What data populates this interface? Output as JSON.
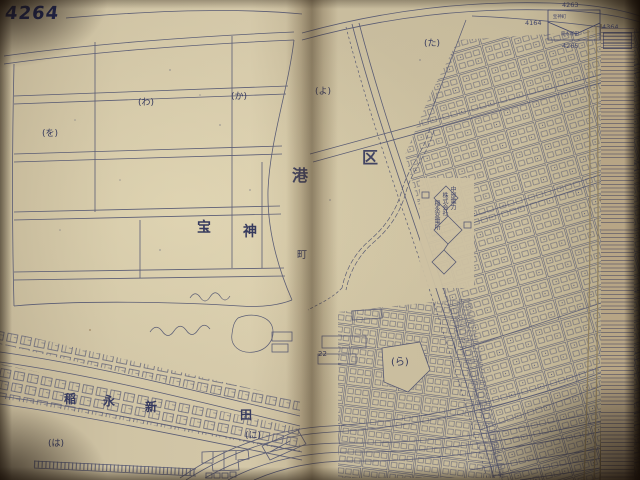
{
  "colors": {
    "ink": "#4a4e6e",
    "paper": "#cdc1a2",
    "handwriting": "#232c63"
  },
  "sheet": {
    "number": "4264"
  },
  "district": {
    "char_left": "港",
    "char_right": "区"
  },
  "left_page": {
    "town": {
      "char1": "宝",
      "char2": "神",
      "char3": "町"
    },
    "blocks": {
      "b1": "(を)",
      "b2": "(わ)",
      "b3": "(か)"
    },
    "village": {
      "char1": "稲",
      "char2": "永",
      "char3": "新",
      "char4": "田"
    },
    "bottom": {
      "b1": "(は)",
      "b2": "(に)"
    }
  },
  "right_page": {
    "blocks": {
      "b1": "(よ)",
      "b2": "(た)",
      "b3": "(ら)"
    },
    "lot_number": "22",
    "substation": {
      "line1": "中部電力",
      "line2": "株式会社",
      "line3": "稲永変電所"
    }
  },
  "index_diagram": {
    "top": "4263",
    "left": "4164",
    "right": "4364",
    "bottom": "4265",
    "name_top": "宝神町",
    "name_bottom": "稲永新田"
  }
}
